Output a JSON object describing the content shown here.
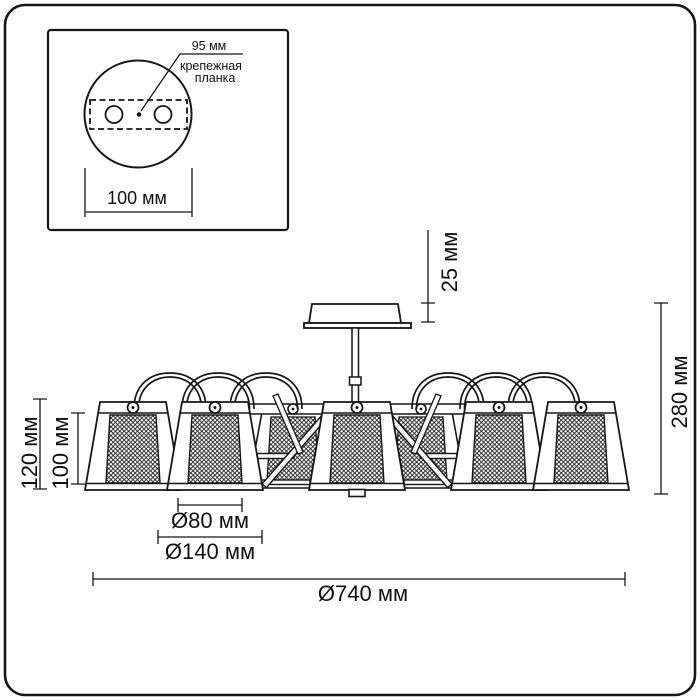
{
  "inset": {
    "hole_spacing_label": "95 мм",
    "plate_label_line1": "крепежная",
    "plate_label_line2": "планка",
    "plate_width_label": "100 мм"
  },
  "dimensions": {
    "canopy_height": "25 мм",
    "fixture_height": "280 мм",
    "shade_outer_height": "120 мм",
    "shade_inner_height": "100 мм",
    "shade_top_diameter": "Ø80 мм",
    "shade_bottom_diameter": "Ø140 мм",
    "fixture_diameter": "Ø740 мм"
  },
  "colors": {
    "ink": "#161616",
    "background": "#ffffff"
  }
}
